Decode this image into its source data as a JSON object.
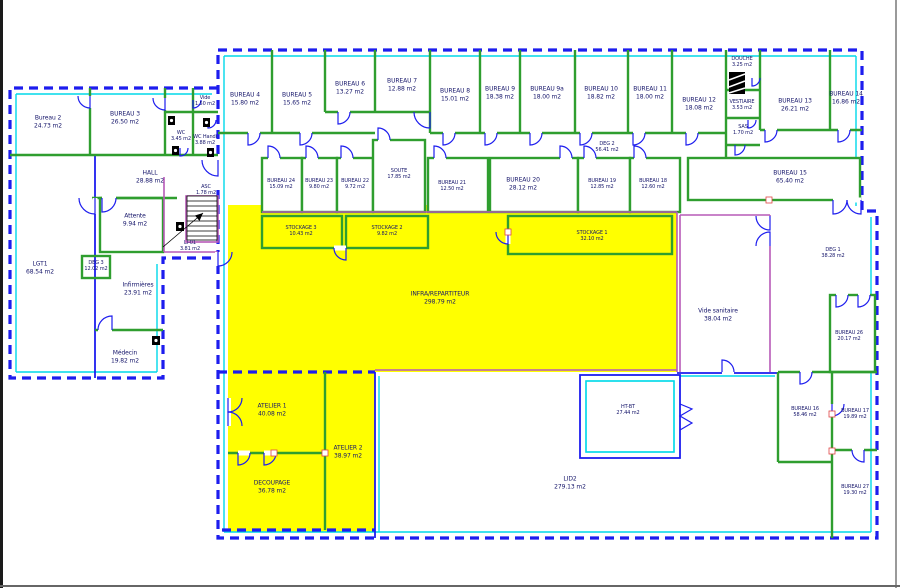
{
  "colors": {
    "blue": "#1d1dee",
    "cyan": "#00d9e9",
    "green": "#2f9e2f",
    "magenta": "#b75ab7",
    "yellow": "#ffff00",
    "text": "#15156a"
  },
  "rooms": {
    "bureau2": {
      "name": "Bureau 2",
      "area": "24.73 m2"
    },
    "bureau3": {
      "name": "BUREAU 3",
      "area": "26.50 m2"
    },
    "vide": {
      "name": "Vide",
      "area": "1.50 m2"
    },
    "wc": {
      "name": "WC",
      "area": "3.45 m2"
    },
    "wchandi": {
      "name": "WC Handi",
      "area": "3.88 m2"
    },
    "hall": {
      "name": "HALL",
      "area": "28.88 m2"
    },
    "attente": {
      "name": "Attente",
      "area": "9.94 m2"
    },
    "asc": {
      "name": "ASC",
      "area": "1.78 m2"
    },
    "li01": {
      "name": "LI-01",
      "area": "3.81 m2"
    },
    "deg3": {
      "name": "DEG 3",
      "area": "12.02 m2"
    },
    "lgt1": {
      "name": "LGT1",
      "area": "68.54 m2"
    },
    "infirmieres": {
      "name": "Infirmières",
      "area": "23.91 m2"
    },
    "medecin": {
      "name": "Médecin",
      "area": "19.82 m2"
    },
    "bureau4": {
      "name": "BUREAU 4",
      "area": "15.80 m2"
    },
    "bureau5": {
      "name": "BUREAU 5",
      "area": "15.65 m2"
    },
    "bureau6": {
      "name": "BUREAU 6",
      "area": "13.27 m2"
    },
    "bureau7": {
      "name": "BUREAU 7",
      "area": "12.88 m2"
    },
    "bureau8": {
      "name": "BUREAU 8",
      "area": "15.01 m2"
    },
    "bureau9": {
      "name": "BUREAU 9",
      "area": "18.38 m2"
    },
    "bureau9a": {
      "name": "BUREAU 9a",
      "area": "18.00 m2"
    },
    "bureau10": {
      "name": "BUREAU 10",
      "area": "18.82 m2"
    },
    "bureau11": {
      "name": "BUREAU 11",
      "area": "18.00 m2"
    },
    "bureau12": {
      "name": "BUREAU 12",
      "area": "18.08 m2"
    },
    "douche": {
      "name": "DOUCHE",
      "area": "3.25 m2"
    },
    "vestiaire": {
      "name": "VESTIAIRE",
      "area": "3.53 m2"
    },
    "sas": {
      "name": "SAS",
      "area": "1.70 m2"
    },
    "bureau13": {
      "name": "BUREAU 13",
      "area": "26.21 m2"
    },
    "bureau14": {
      "name": "BUREAU 14",
      "area": "16.86 m2"
    },
    "deg2": {
      "name": "DEG 2",
      "area": "56.41 m2"
    },
    "bureau15": {
      "name": "BUREAU 15",
      "area": "65.40 m2"
    },
    "bureau24": {
      "name": "BUREAU 24",
      "area": "15.09 m2"
    },
    "bureau23": {
      "name": "BUREAU 23",
      "area": "9.80 m2"
    },
    "bureau22": {
      "name": "BUREAU 22",
      "area": "9.72 m2"
    },
    "soute": {
      "name": "SOUTE",
      "area": "17.85 m2"
    },
    "bureau21": {
      "name": "BUREAU 21",
      "area": "12.50 m2"
    },
    "bureau20": {
      "name": "BUREAU 20",
      "area": "28.12 m2"
    },
    "bureau19": {
      "name": "BUREAU 19",
      "area": "12.85 m2"
    },
    "bureau18": {
      "name": "BUREAU 18",
      "area": "12.60 m2"
    },
    "stockage3": {
      "name": "STOCKAGE 3",
      "area": "10.43 m2"
    },
    "stockage2": {
      "name": "STOCKAGE 2",
      "area": "9.82 m2"
    },
    "stockage1": {
      "name": "STOCKAGE 1",
      "area": "32.10 m2"
    },
    "infra": {
      "name": "INFRA/REPARTITEUR",
      "area": "298.79 m2"
    },
    "atelier1": {
      "name": "ATELIER 1",
      "area": "40.08 m2"
    },
    "atelier2": {
      "name": "ATELIER 2",
      "area": "38.97 m2"
    },
    "decoupage": {
      "name": "DECOUPAGE",
      "area": "36.78 m2"
    },
    "deg1": {
      "name": "DEG 1",
      "area": "38.28 m2"
    },
    "videsanitaire": {
      "name": "Vide sanitaire",
      "area": "38.04 m2"
    },
    "bureau26": {
      "name": "BUREAU 26",
      "area": "20.17 m2"
    },
    "bureau16": {
      "name": "BUREAU 16",
      "area": "58.46 m2"
    },
    "bureau17": {
      "name": "BUREAU 17",
      "area": "19.89 m2"
    },
    "bureau27": {
      "name": "BUREAU 27",
      "area": "19.30 m2"
    },
    "htbt": {
      "name": "HT-BT",
      "area": "27.44 m2"
    },
    "lid2": {
      "name": "LID2",
      "area": "279.13 m2"
    }
  }
}
